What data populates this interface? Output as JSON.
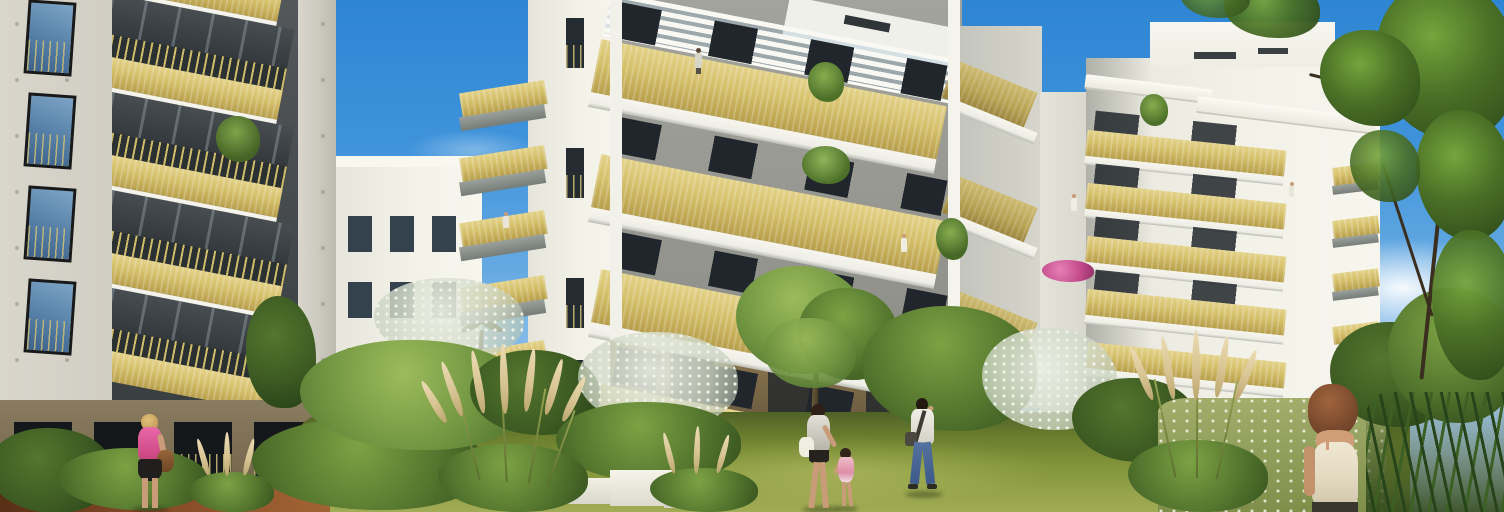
{
  "scene": {
    "type": "architectural_rendering",
    "setting": "Sunny 3D rendering of a modern apartment residence with gold balconies and a landscaped garden courtyard",
    "sky": {
      "label": "blue sky with soft white clouds",
      "top_color": "#2e85d3",
      "horizon_color": "#d6e7f7",
      "cloud_color": "#ffffff"
    },
    "palette": {
      "gold_balcony": "#d5bf6a",
      "gold_shadow": "#99833e",
      "white_facade": "#f3f2e9",
      "concrete_gray": "#ccc9bf",
      "recess_gray": "#a4a59e",
      "window_dark": "#20262b",
      "window_glass_blue": "#557fa6",
      "base_brown": "#8a7450",
      "lawn_green": "#84953b",
      "shrub_green": "#47682a",
      "blossom_white": "#e9ece1",
      "pampas_tan": "#d8c493",
      "path_brown": "#8a4f28",
      "flower_pink": "#d85f9f"
    },
    "buildings": [
      {
        "id": "left-tower",
        "label": "left concrete apartment tower with dark glazing and gold balcony rails",
        "floors_visible": 5
      },
      {
        "id": "background-block",
        "label": "low white apartment block in the background",
        "floors_visible": 4
      },
      {
        "id": "mid-tower",
        "label": "white tower with stacked gold corner balconies and a palm at its base",
        "floors_visible": 5
      },
      {
        "id": "center-building",
        "label": "main white building with wide gold balconies and a white roof pergola",
        "floors_visible": 5
      },
      {
        "id": "right-tower",
        "label": "right white tower with gold balconies, white awnings and pink balcony flowers",
        "floors_visible": 6
      }
    ],
    "people": [
      {
        "id": "woman-left",
        "label": "blonde woman in a pink top and black skirt carrying a brown handbag"
      },
      {
        "id": "mother",
        "label": "mother in a light summer dress walking across the lawn"
      },
      {
        "id": "child",
        "label": "little girl in a pink dress holding her mother's hand"
      },
      {
        "id": "man",
        "label": "man in a white shirt and jeans walking while on his phone"
      },
      {
        "id": "woman-foreground",
        "label": "brown-haired woman in a cream tank top seen from behind"
      },
      {
        "id": "balcony-residents",
        "label": "small resident figures standing on balconies",
        "count": 5
      }
    ],
    "vegetation": [
      {
        "id": "lawn",
        "label": "sunlit garden lawn"
      },
      {
        "id": "shrubs",
        "label": "dense green shrubs and hedges around the garden"
      },
      {
        "id": "blossom-trees",
        "label": "white flowering trees",
        "count": 3
      },
      {
        "id": "center-tree",
        "label": "young leafy tree on the lawn"
      },
      {
        "id": "pampas",
        "label": "tan pampas grass plumes",
        "count": 4
      },
      {
        "id": "right-tree",
        "label": "large leafy tree framing the right edge"
      },
      {
        "id": "balcony-plants",
        "label": "potted plants and pink flowers on balconies"
      }
    ],
    "objects": [
      {
        "id": "white-planters",
        "label": "white planter blocks at the lawn edge"
      },
      {
        "id": "wooden-path",
        "label": "brown garden path in the lower left"
      },
      {
        "id": "pergola",
        "label": "white slatted pergola on the center roof"
      },
      {
        "id": "awnings",
        "label": "white balcony awnings on the right tower"
      }
    ]
  }
}
